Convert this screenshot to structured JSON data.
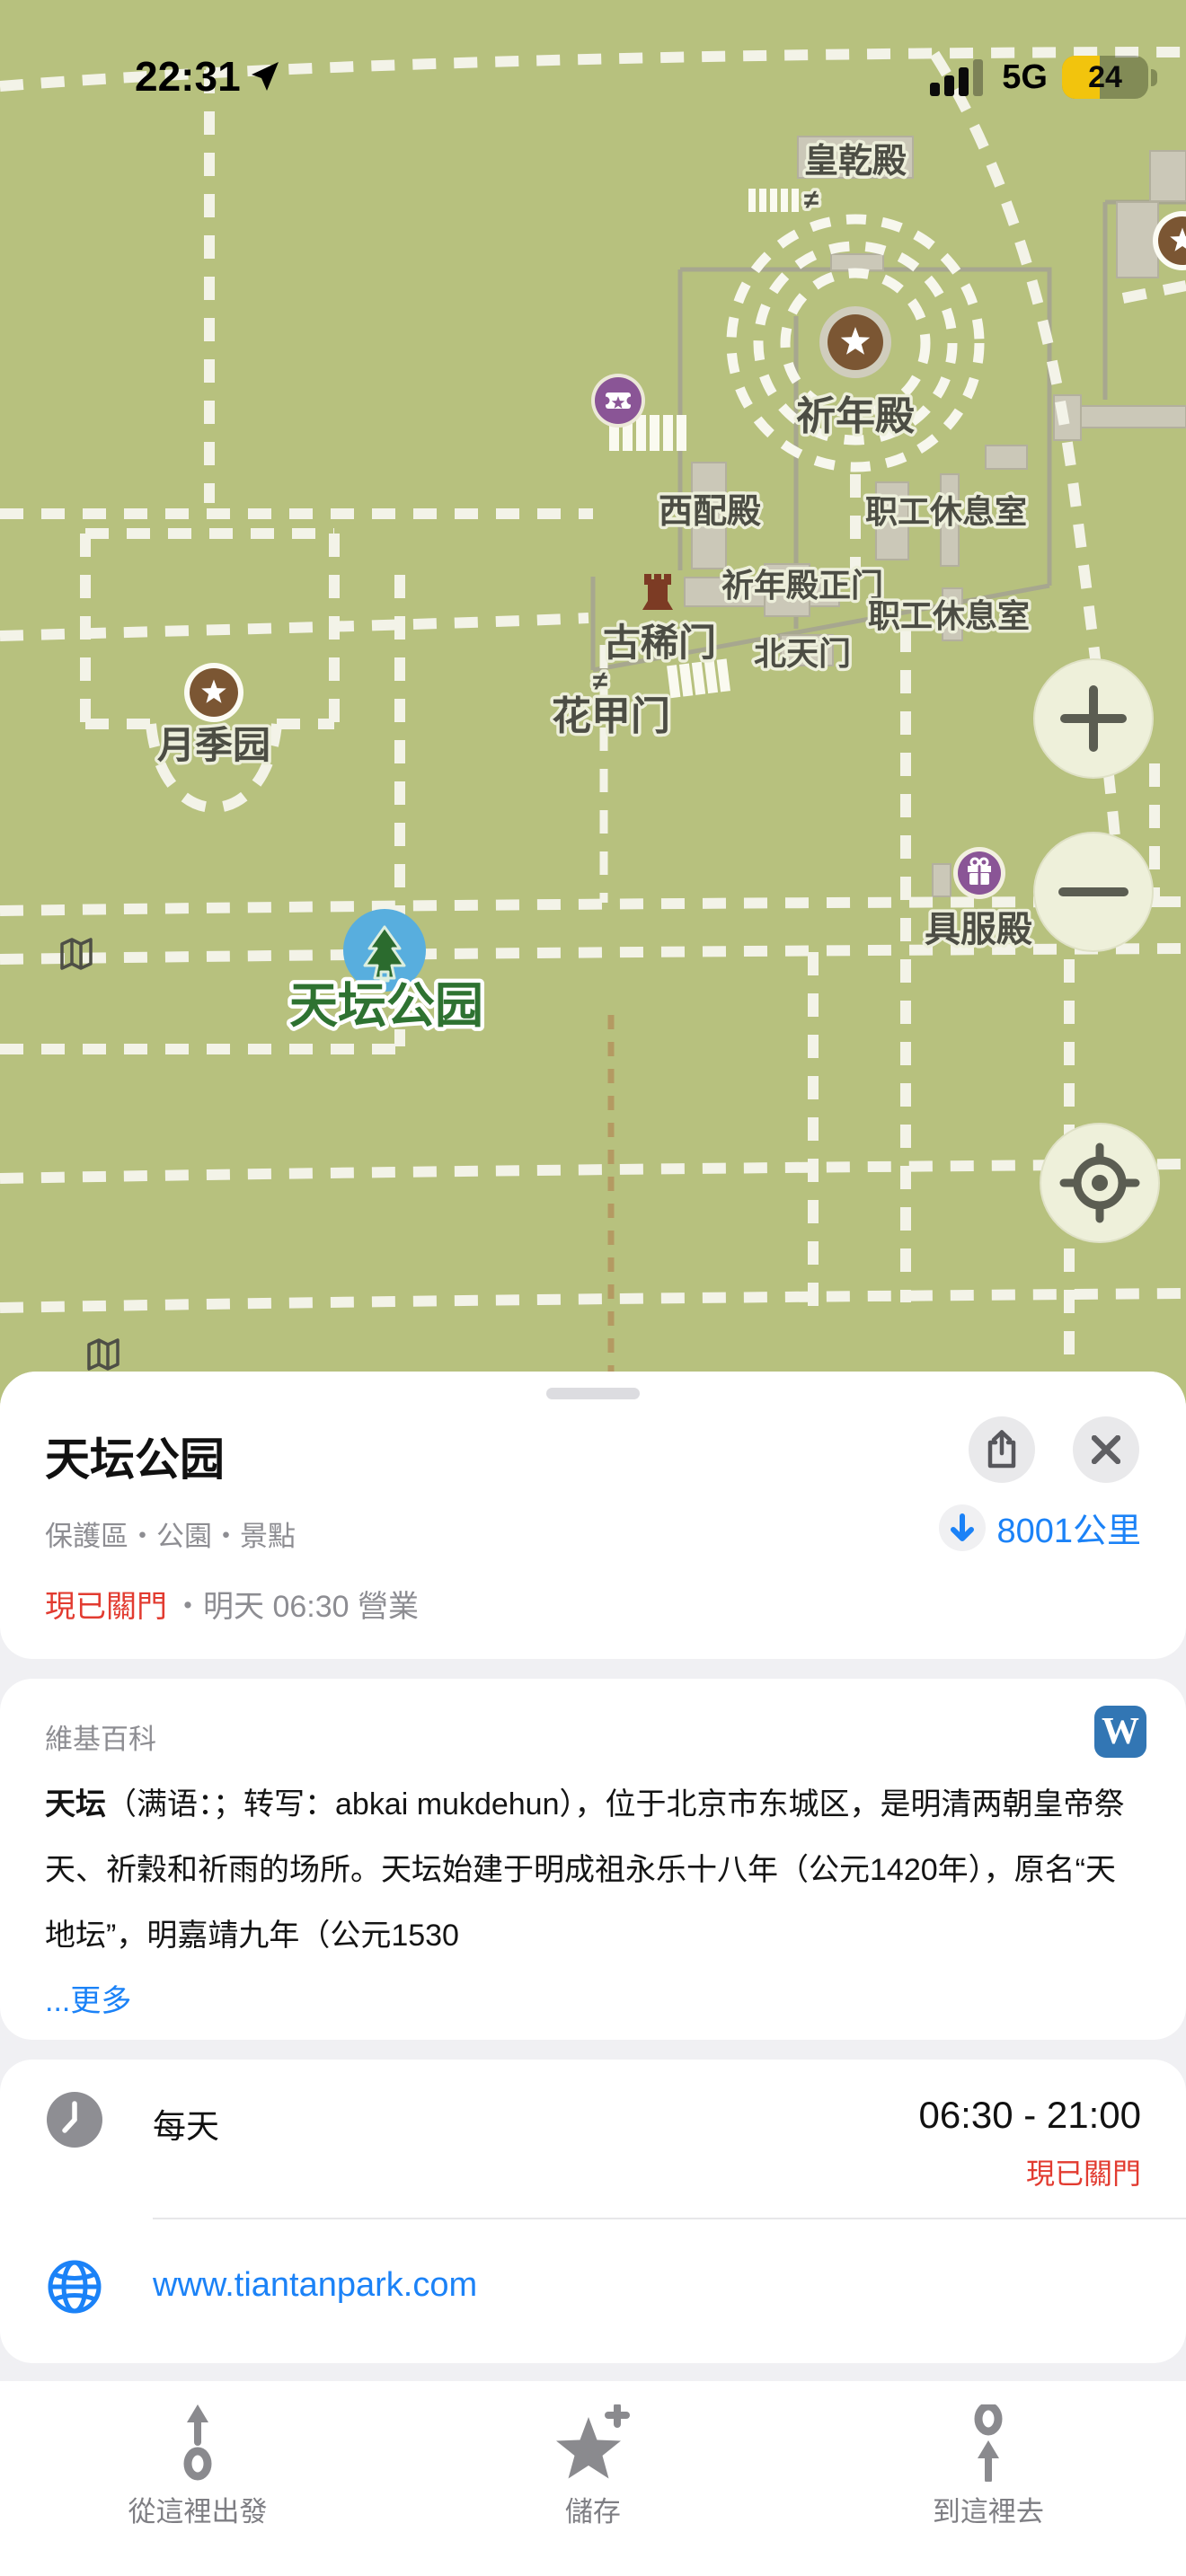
{
  "status_bar": {
    "time": "22:31",
    "network": "5G",
    "battery_percent": "24"
  },
  "map": {
    "labels": {
      "huangqiandian": "皇乾殿",
      "qiniandian": "祈年殿",
      "xipeidian": "西配殿",
      "xiuxishi1": "职工休息室",
      "zhengmen": "祈年殿正门",
      "xiuxishi2": "职工休息室",
      "beitianmen": "北天门",
      "guximen": "古稀门",
      "huajiamen": "花甲门",
      "yuejiyuan": "月季园",
      "jufudian": "具服殿",
      "park": "天坛公园",
      "neq1": "≠",
      "neq2": "≠"
    }
  },
  "sheet": {
    "title": "天坛公园",
    "category": "保護區・公園・景點",
    "distance": "8001公里",
    "status_closed": "現已關門",
    "status_open_info": "・明天 06:30 營業",
    "wiki": {
      "header": "維基百科",
      "badge": "W",
      "bold_lead": "天坛",
      "body": "（满语：；转写：abkai mukdehun），位于北京市东城区，是明清两朝皇帝祭天、祈穀和祈雨的场所。天坛始建于明成祖永乐十八年（公元1420年），原名“天地坛”，明嘉靖九年（公元1530",
      "more_link": "...更多"
    },
    "hours": {
      "label": "每天",
      "time": "06:30 - 21:00",
      "status": "現已關門"
    },
    "website": "www.tiantanpark.com"
  },
  "toolbar": {
    "from_here": "從這裡出發",
    "save": "儲存",
    "to_here": "到這裡去"
  },
  "colors": {
    "map_green": "#b7c17e",
    "path_white": "#f3f3e8",
    "accent_blue": "#1b82f7",
    "closed_red": "#e23b30",
    "poi_brown": "#7b5633",
    "poi_purple": "#8a5596",
    "pin_blue": "#58aede",
    "wiki_badge_blue": "#3276b4",
    "battery_yellow": "#f2c40d"
  }
}
